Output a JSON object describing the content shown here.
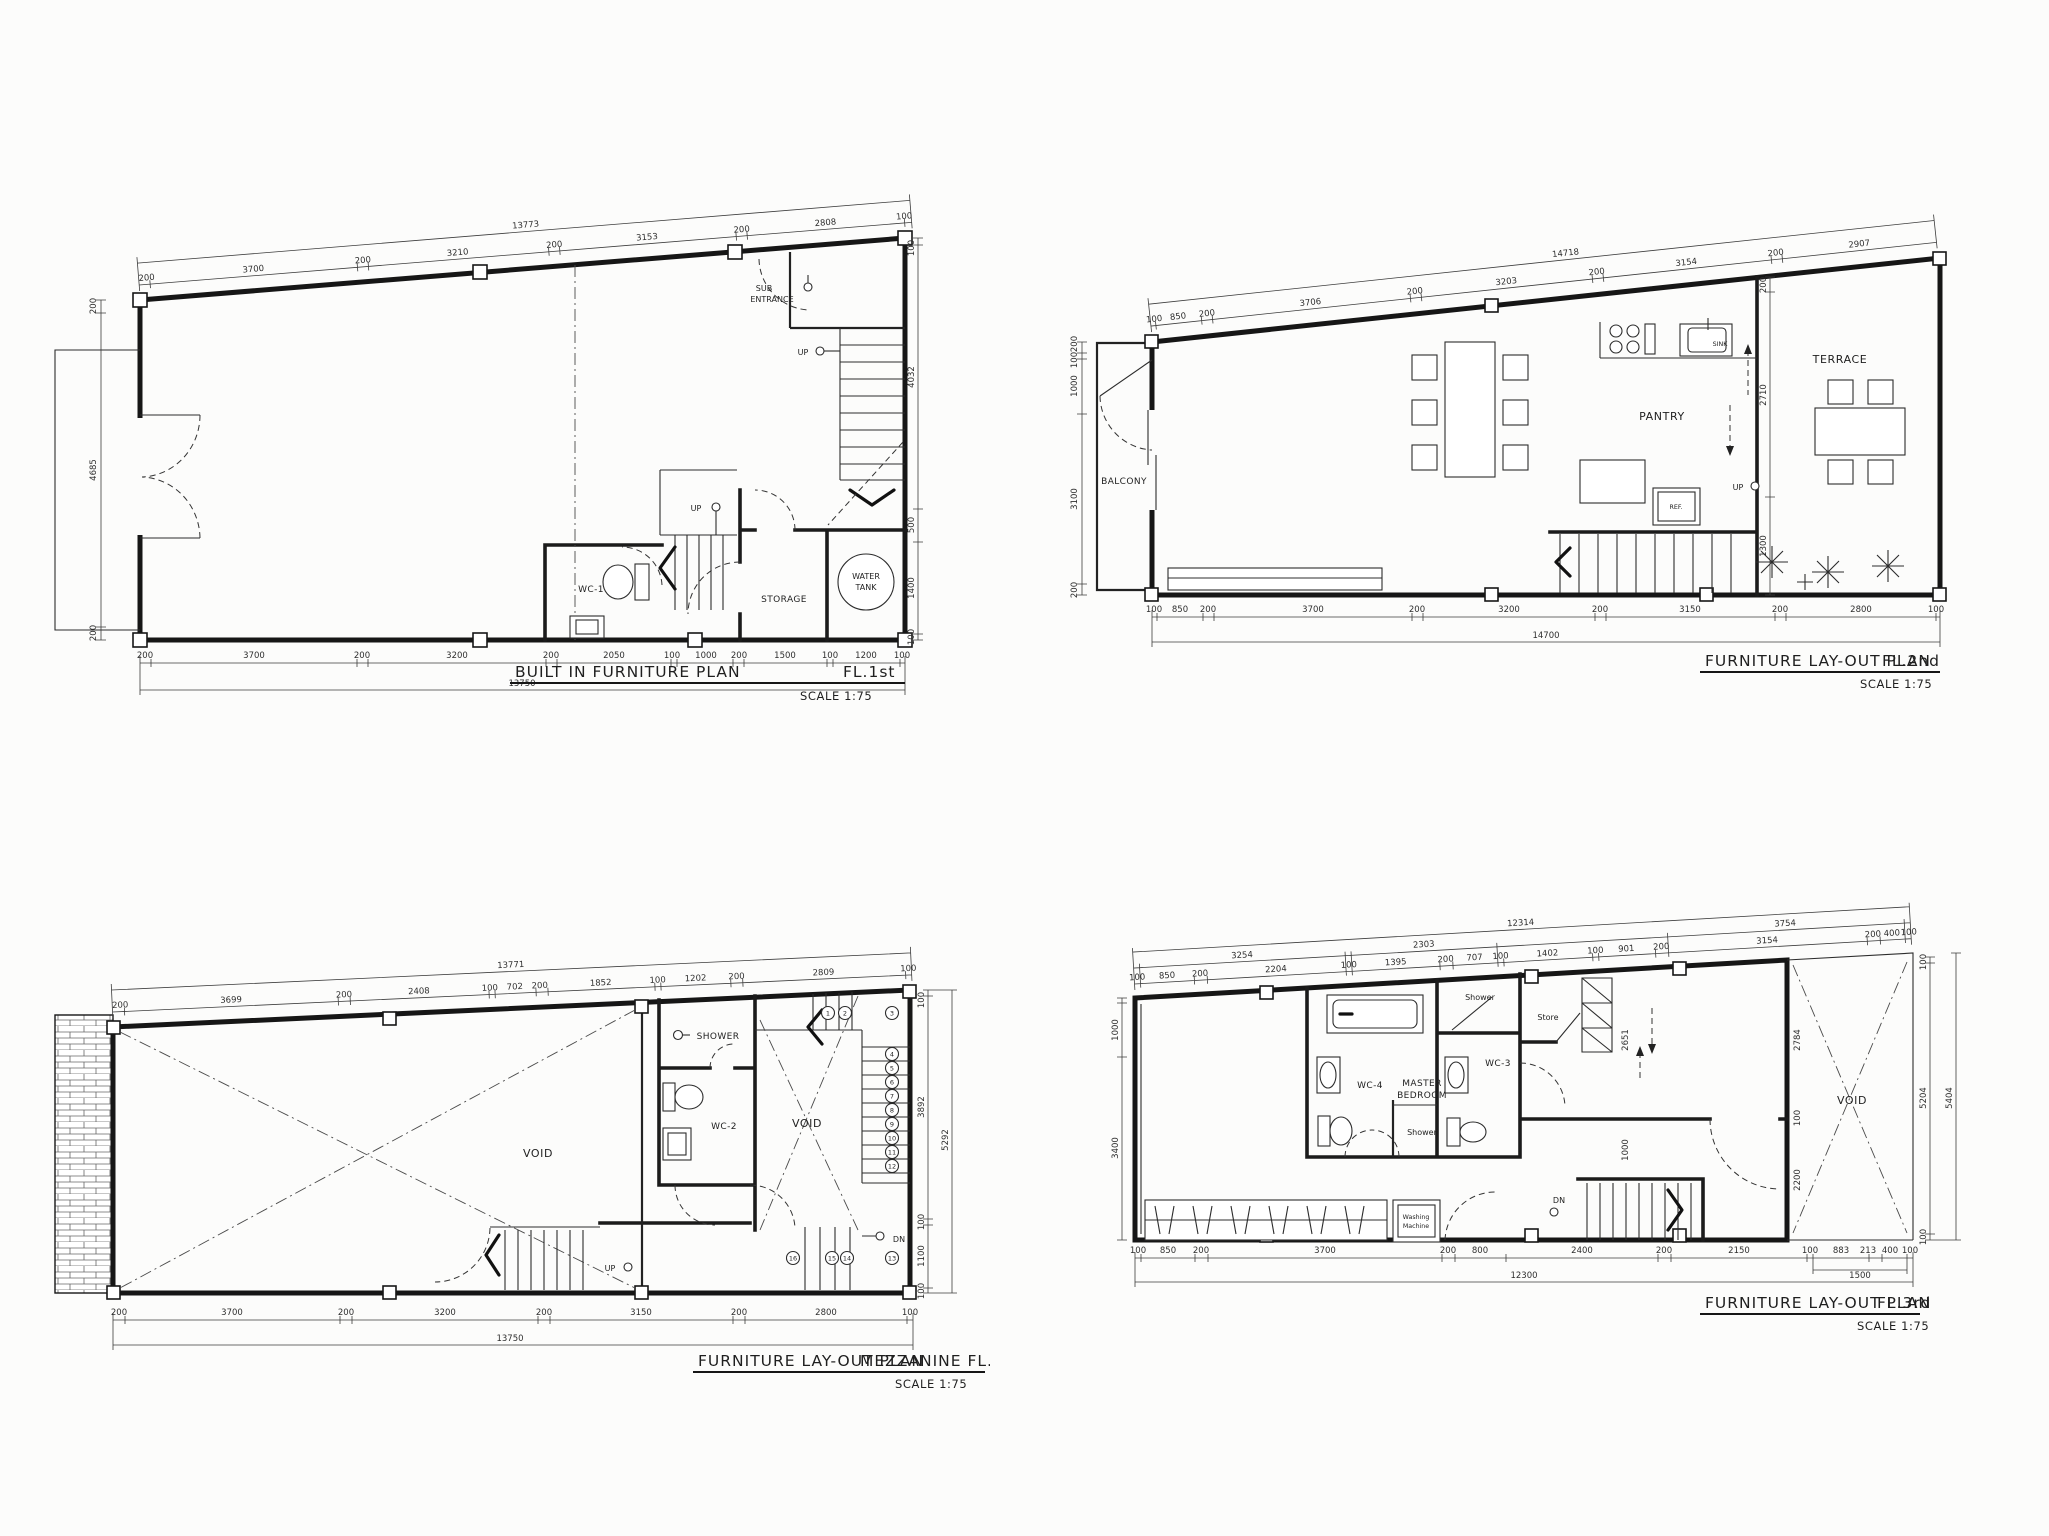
{
  "colors": {
    "ink": "#1a1a1a",
    "paper": "#fcfcfb",
    "dim_text": "#2e2e2e"
  },
  "plans": {
    "fl1": {
      "title": "BUILT IN FURNITURE PLAN",
      "floor": "FL.1st",
      "scale": "SCALE 1:75",
      "labels": {
        "sub_entrance_1": "SUB",
        "sub_entrance_2": "ENTRANCE",
        "up_stair": "UP",
        "up_mid": "UP",
        "wc1": "WC-1",
        "storage": "STORAGE",
        "water_1": "WATER",
        "water_2": "TANK"
      },
      "dims": {
        "top_total": "13773",
        "top": [
          "200",
          "3700",
          "200",
          "3210",
          "200",
          "3153",
          "200",
          "2808",
          "100"
        ],
        "bottom": [
          "200",
          "3700",
          "200",
          "3200",
          "200",
          "2050",
          "100",
          "1000",
          "200",
          "1500",
          "100",
          "1200",
          "100"
        ],
        "bottom_total": "13750",
        "left": [
          "200",
          "4685",
          "200"
        ],
        "right": [
          "100",
          "4032",
          "500",
          "1400",
          "100"
        ]
      }
    },
    "fl2": {
      "title": "FURNITURE LAY-OUT PLAN",
      "floor": "FL.2nd",
      "scale": "SCALE 1:75",
      "labels": {
        "balcony": "BALCONY",
        "pantry": "PANTRY",
        "terrace": "TERRACE",
        "sink": "SINK",
        "ref": "REF.",
        "up": "UP"
      },
      "dims": {
        "top_total": "14718",
        "top": [
          "100",
          "850",
          "200",
          "3706",
          "200",
          "3203",
          "200",
          "3154",
          "200",
          "2907"
        ],
        "bottom": [
          "100",
          "850",
          "200",
          "3700",
          "200",
          "3200",
          "200",
          "3150",
          "200",
          "2800",
          "100"
        ],
        "bottom_total": "14700",
        "left": [
          "200",
          "100",
          "1000",
          "3100",
          "200"
        ],
        "right_inner": [
          "200",
          "2710",
          "1300"
        ]
      }
    },
    "mezz": {
      "title": "FURNITURE LAY-OUT PLAN",
      "floor": "MEZZANINE FL.",
      "scale": "SCALE 1:75",
      "labels": {
        "void_left": "VOID",
        "void_right": "VOID",
        "shower": "SHOWER",
        "wc2": "WC-2",
        "up": "UP",
        "dn": "DN"
      },
      "steps": [
        "1",
        "2",
        "3",
        "4",
        "5",
        "6",
        "7",
        "8",
        "9",
        "10",
        "11",
        "12",
        "13",
        "14",
        "15",
        "16"
      ],
      "dims": {
        "top_total": "13771",
        "top": [
          "200",
          "3699",
          "200",
          "2408",
          "100",
          "702",
          "200",
          "1852",
          "100",
          "1202",
          "200",
          "2809",
          "100"
        ],
        "bottom": [
          "200",
          "3700",
          "200",
          "3200",
          "200",
          "3150",
          "200",
          "2800",
          "100"
        ],
        "bottom_total": "13750",
        "right": [
          "100",
          "3892",
          "100",
          "1100",
          "100"
        ],
        "right_total": "5292"
      }
    },
    "fl3": {
      "title": "FURNITURE LAY-OUT PLAN",
      "floor": "FL.3rd",
      "scale": "SCALE 1:75",
      "labels": {
        "wc4": "WC-4",
        "master_1": "MASTER",
        "master_2": "BEDROOM",
        "shower_top": "Shower",
        "shower_mid": "Shower",
        "store": "Store",
        "wc3": "WC-3",
        "void": "VOID",
        "washing_1": "Washing",
        "washing_2": "Machine",
        "dn": "DN"
      },
      "dims": {
        "top_total": "12314",
        "top_mid": [
          "3254",
          "2303",
          "3754"
        ],
        "top": [
          "100",
          "850",
          "200",
          "2204",
          "100",
          "1395",
          "200",
          "707",
          "100",
          "1402",
          "100",
          "901",
          "200",
          "3154",
          "200",
          "400",
          "100"
        ],
        "bottom": [
          "100",
          "850",
          "200",
          "3700",
          "200",
          "800",
          "2400",
          "200",
          "2150",
          "100",
          "883",
          "213",
          "400",
          "100"
        ],
        "bottom_sub": "1500",
        "bottom_total": "12300",
        "left": [
          "1000",
          "3400"
        ],
        "right": [
          "100",
          "5204",
          "100"
        ],
        "right_total": "5404",
        "inner": {
          "v2651": "2651",
          "v1000": "1000",
          "v2784": "2784",
          "v100": "100",
          "v2200": "2200"
        }
      }
    }
  }
}
